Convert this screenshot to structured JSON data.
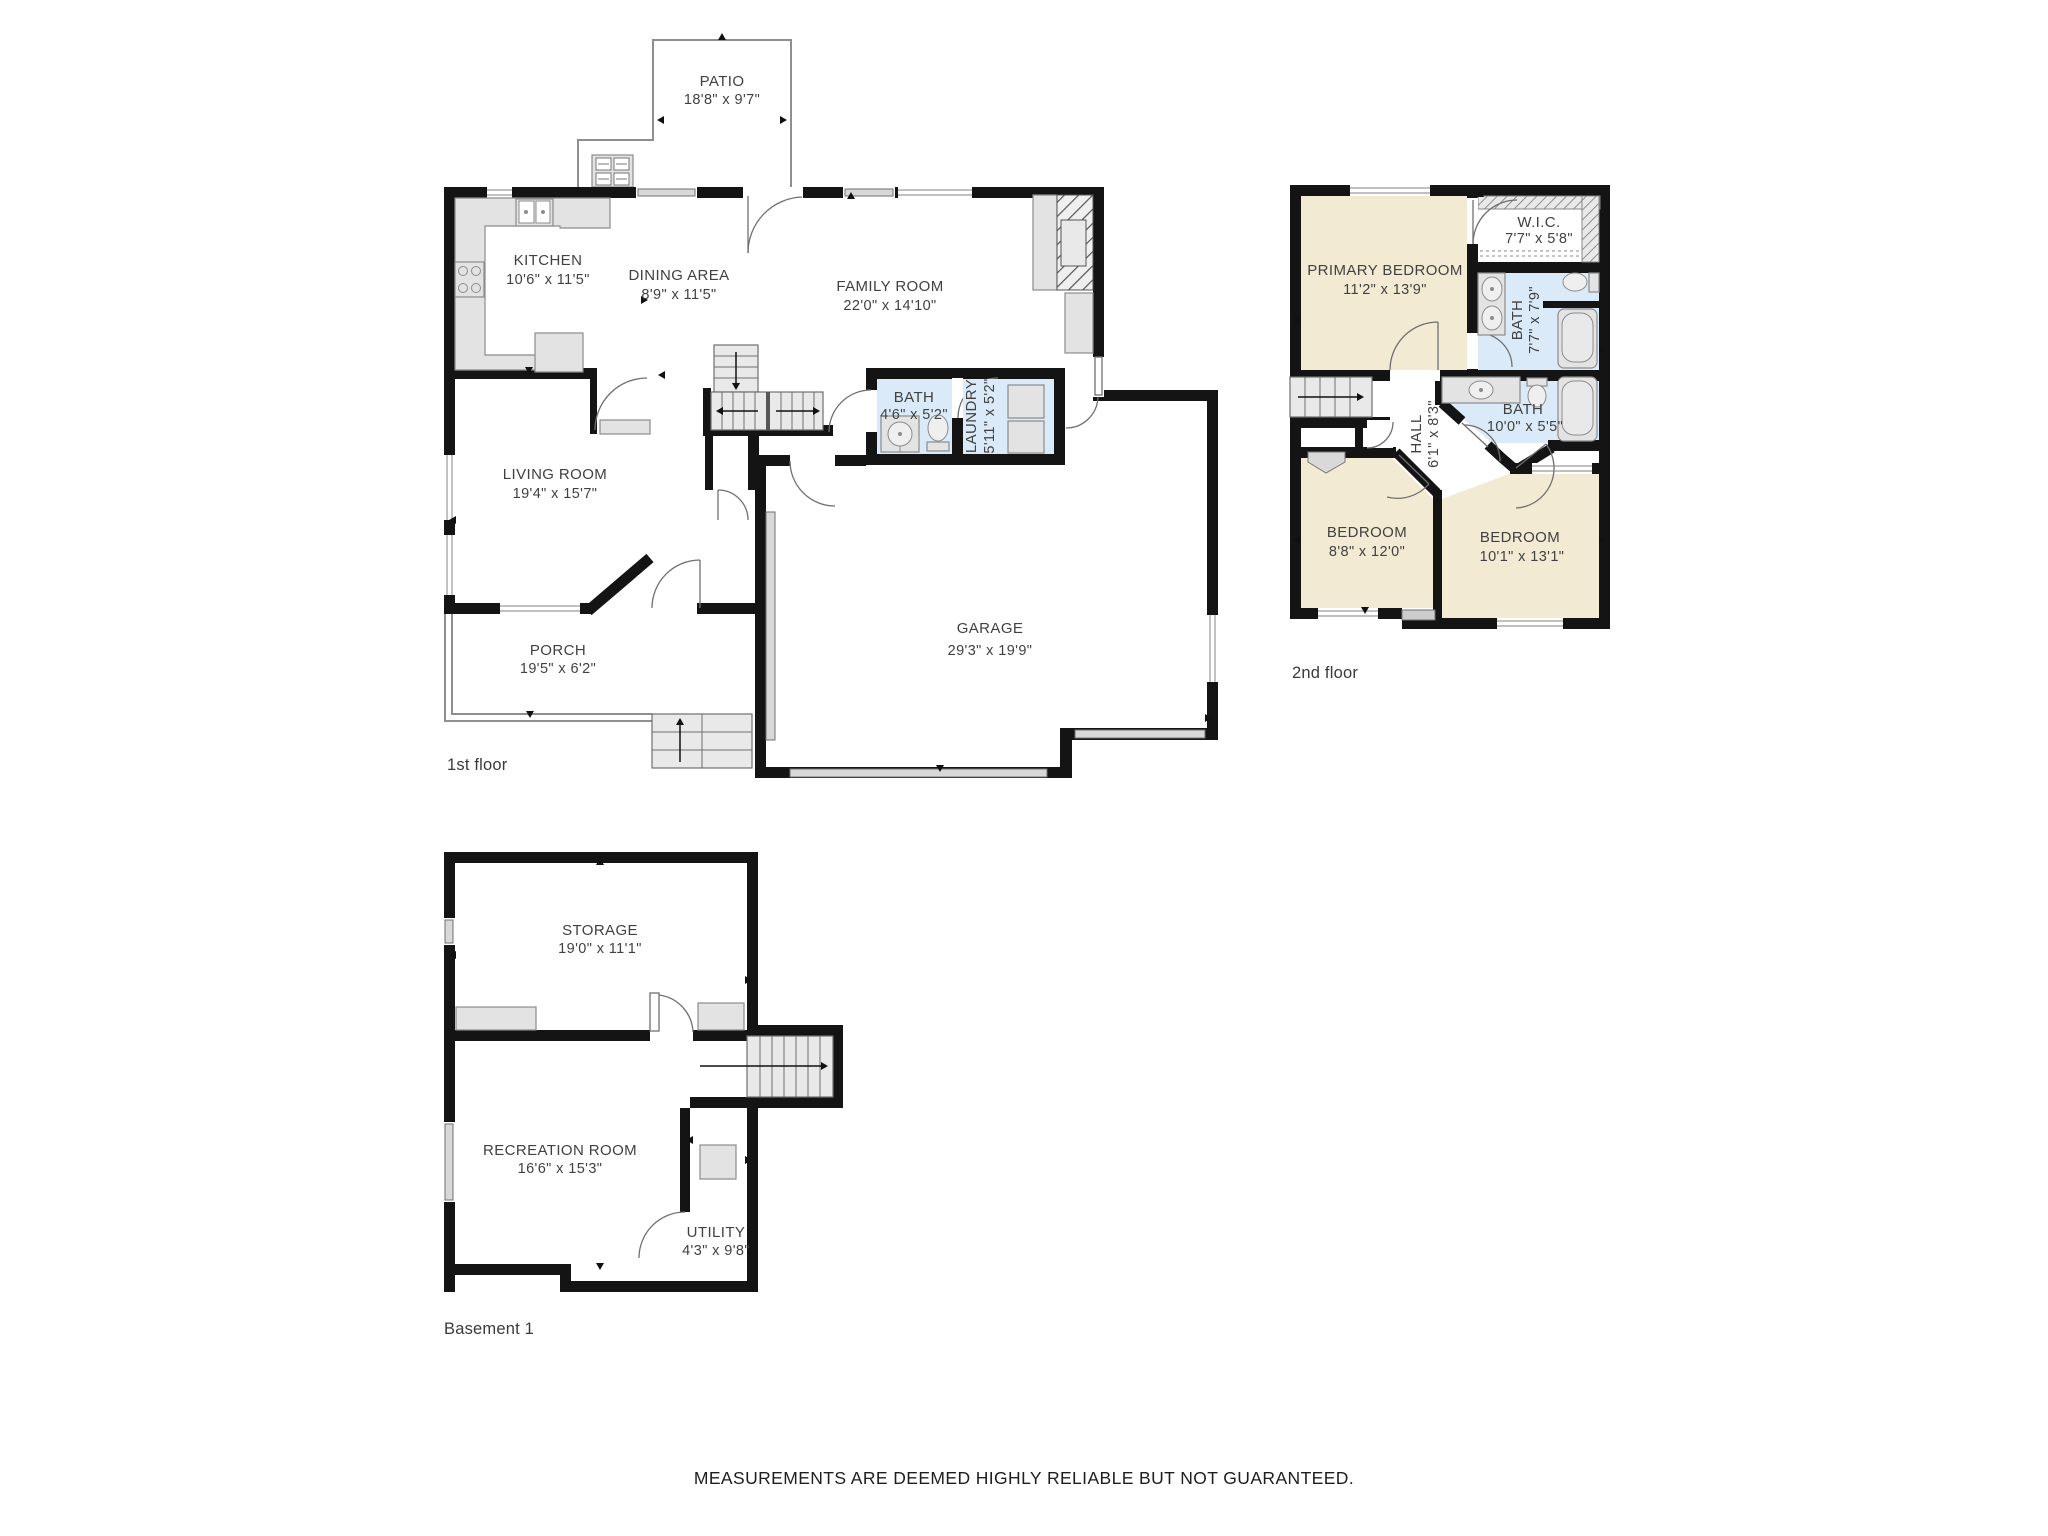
{
  "footer": {
    "disclaimer": "MEASUREMENTS ARE DEEMED HIGHLY RELIABLE BUT NOT GUARANTEED."
  },
  "colors": {
    "wall": "#141414",
    "bedroom_tan": "#f2ead3",
    "bath_blue": "#daeaf8",
    "fixture_gray": "#e3e3e3",
    "outline_gray": "#8f8f8f",
    "label_text": "#414141"
  },
  "floors": [
    {
      "label": "1st floor",
      "rooms": [
        {
          "name": "PATIO",
          "dims": "18'8\" x 9'7\""
        },
        {
          "name": "KITCHEN",
          "dims": "10'6\" x 11'5\""
        },
        {
          "name": "DINING AREA",
          "dims": "8'9\" x 11'5\""
        },
        {
          "name": "FAMILY ROOM",
          "dims": "22'0\" x 14'10\""
        },
        {
          "name": "BATH",
          "dims": "4'6\" x 5'2\""
        },
        {
          "name": "LAUNDRY",
          "dims": "5'11\" x 5'2\""
        },
        {
          "name": "LIVING ROOM",
          "dims": "19'4\" x 15'7\""
        },
        {
          "name": "GARAGE",
          "dims": "29'3\" x 19'9\""
        },
        {
          "name": "PORCH",
          "dims": "19'5\" x 6'2\""
        }
      ]
    },
    {
      "label": "2nd floor",
      "rooms": [
        {
          "name": "PRIMARY BEDROOM",
          "dims": "11'2\" x 13'9\""
        },
        {
          "name": "W.I.C.",
          "dims": "7'7\" x 5'8\""
        },
        {
          "name": "BATH",
          "dims": "7'7\" x 7'9\""
        },
        {
          "name": "BATH",
          "dims": "10'0\" x 5'5\""
        },
        {
          "name": "HALL",
          "dims": "6'1\" x 8'3\""
        },
        {
          "name": "BEDROOM",
          "dims": "8'8\" x 12'0\""
        },
        {
          "name": "BEDROOM",
          "dims": "10'1\" x 13'1\""
        }
      ]
    },
    {
      "label": "Basement 1",
      "rooms": [
        {
          "name": "STORAGE",
          "dims": "19'0\" x 11'1\""
        },
        {
          "name": "RECREATION ROOM",
          "dims": "16'6\" x 15'3\""
        },
        {
          "name": "UTILITY",
          "dims": "4'3\" x 9'8\""
        }
      ]
    }
  ]
}
